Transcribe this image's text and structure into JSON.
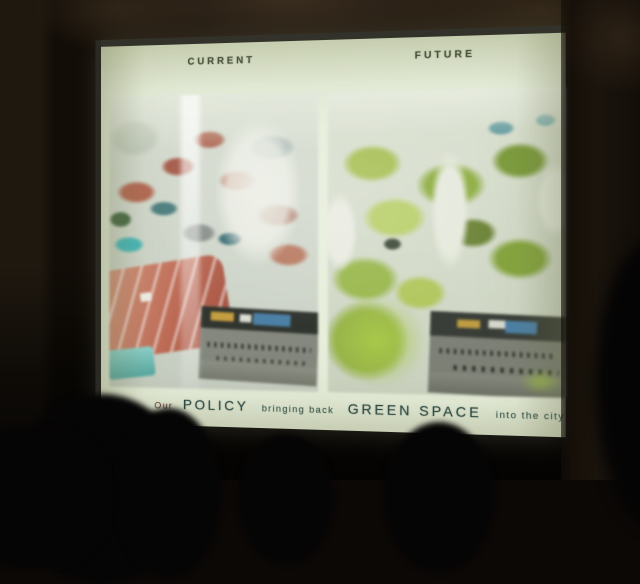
{
  "slide": {
    "current_label": "CURRENT",
    "future_label": "FUTURE",
    "caption": {
      "intro": "Our",
      "policy": "POLICY",
      "middle": "bringing back",
      "green_space": "GREEN SPACE",
      "outro": "into the city"
    },
    "colors": {
      "slide_bg": "#e7eedb",
      "label_text": "#3e4638",
      "caption_large": "#2e4a44",
      "caption_small": "#3d5a50",
      "caption_intro": "#7c4a3a",
      "roof_red": "#bd6a55",
      "green_canopy": "#96b24a",
      "street_dark": "#474b44",
      "awning_blue": "#4c80a6",
      "awning_yellow": "#c49e40",
      "shopfront_cyan": "#49b8b8"
    }
  }
}
